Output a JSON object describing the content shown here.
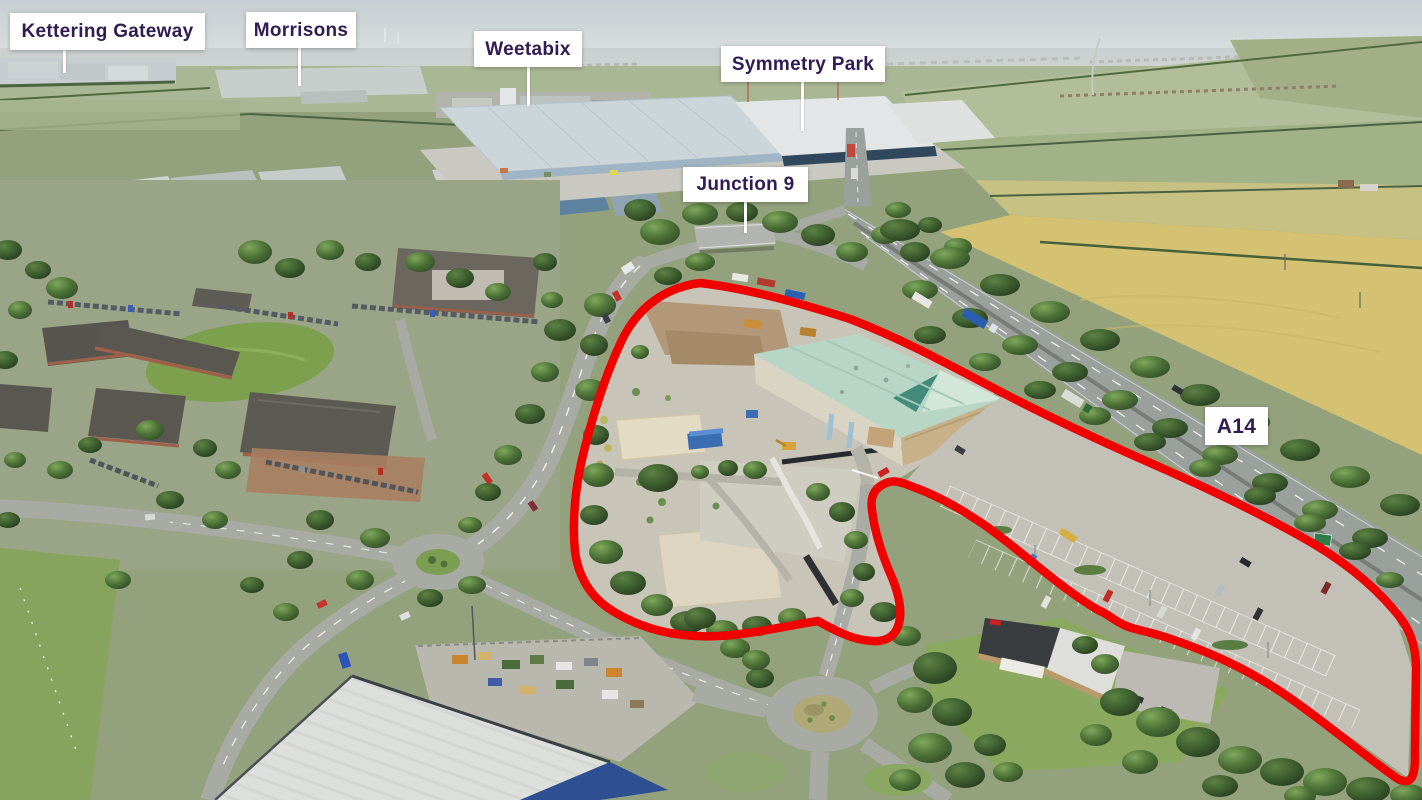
{
  "annotations": {
    "labels": [
      {
        "id": "kettering-gateway",
        "text": "Kettering Gateway",
        "leader_line": true
      },
      {
        "id": "morrisons",
        "text": "Morrisons",
        "leader_line": true
      },
      {
        "id": "weetabix",
        "text": "Weetabix",
        "leader_line": true
      },
      {
        "id": "symmetry-park",
        "text": "Symmetry Park",
        "leader_line": true
      },
      {
        "id": "junction-9",
        "text": "Junction 9",
        "leader_line": true
      },
      {
        "id": "a14",
        "text": "A14",
        "leader_line": false
      }
    ],
    "colors": {
      "boundary-red": "#f10000",
      "label-text": "#321b52",
      "label-bg": "#ffffff",
      "leader-line": "#ffffff"
    }
  }
}
